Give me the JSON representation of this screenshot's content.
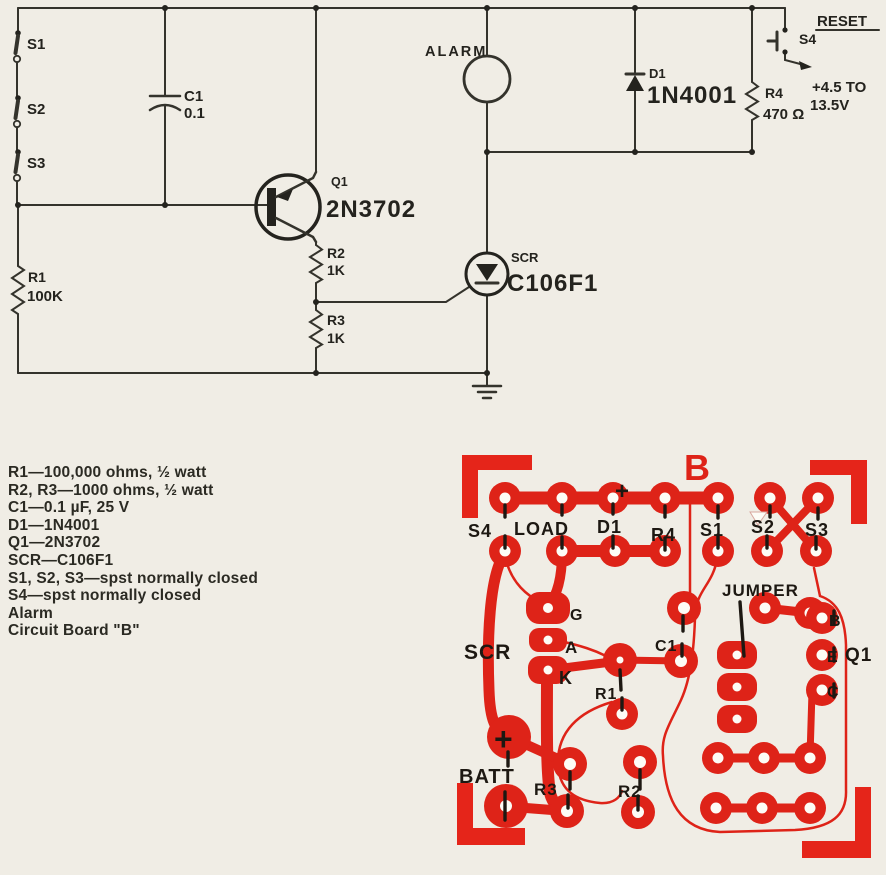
{
  "colors": {
    "paper": "#f0ede5",
    "ink": "#34332c",
    "text": "#24231e",
    "copper": "#de2318",
    "silk": "#1d1812",
    "hole": "#fdfcf6"
  },
  "schematic": {
    "labels": {
      "s1": "S1",
      "s2": "S2",
      "s3": "S3",
      "c1_ref": "C1",
      "c1_val": "0.1",
      "r1_ref": "R1",
      "r1_val": "100K",
      "q1_ref": "Q1",
      "q1_val": "2N3702",
      "r2_ref": "R2",
      "r2_val": "1K",
      "r3_ref": "R3",
      "r3_val": "1K",
      "alarm": "ALARM",
      "scr_ref": "SCR",
      "scr_val": "C106F1",
      "d1_ref": "D1",
      "d1_val": "1N4001",
      "r4_ref": "R4",
      "r4_val": "470 Ω",
      "s4": "S4",
      "reset": "RESET",
      "supply_line1": "+4.5 TO",
      "supply_line2": "13.5V"
    }
  },
  "parts_list": {
    "lines": [
      "R1—100,000 ohms, ½ watt",
      "R2, R3—1000 ohms, ½ watt",
      "C1—0.1 µF, 25 V",
      "D1—1N4001",
      "Q1—2N3702",
      "SCR—C106F1",
      "S1, S2, S3—spst normally closed",
      "S4—spst normally closed",
      "Alarm",
      "Circuit Board \"B\""
    ]
  },
  "pcb": {
    "title": "B",
    "labels": [
      {
        "text": "S4",
        "x": 468,
        "y": 537,
        "size": 18
      },
      {
        "text": "LOAD",
        "x": 514,
        "y": 535,
        "size": 18
      },
      {
        "text": "D1",
        "x": 597,
        "y": 533,
        "size": 18
      },
      {
        "text": "R4",
        "x": 651,
        "y": 541,
        "size": 18
      },
      {
        "text": "S1",
        "x": 700,
        "y": 536,
        "size": 18
      },
      {
        "text": "S2",
        "x": 751,
        "y": 533,
        "size": 18
      },
      {
        "text": "S3",
        "x": 805,
        "y": 536,
        "size": 18
      },
      {
        "text": "+",
        "x": 615,
        "y": 499,
        "size": 24
      },
      {
        "text": "JUMPER",
        "x": 722,
        "y": 596,
        "size": 17
      },
      {
        "text": "C1",
        "x": 655,
        "y": 651,
        "size": 16
      },
      {
        "text": "SCR",
        "x": 464,
        "y": 659,
        "size": 21
      },
      {
        "text": "G",
        "x": 570,
        "y": 620,
        "size": 16
      },
      {
        "text": "A",
        "x": 565,
        "y": 653,
        "size": 17
      },
      {
        "text": "K",
        "x": 559,
        "y": 684,
        "size": 18
      },
      {
        "text": "R1",
        "x": 595,
        "y": 699,
        "size": 16
      },
      {
        "text": "B",
        "x": 829,
        "y": 626,
        "size": 16
      },
      {
        "text": "E",
        "x": 827,
        "y": 662,
        "size": 16
      },
      {
        "text": "Q1",
        "x": 845,
        "y": 661,
        "size": 19
      },
      {
        "text": "C",
        "x": 827,
        "y": 697,
        "size": 16
      },
      {
        "text": "+",
        "x": 494,
        "y": 750,
        "size": 32
      },
      {
        "text": "BATT",
        "x": 459,
        "y": 783,
        "size": 20
      },
      {
        "text": "R3",
        "x": 534,
        "y": 795,
        "size": 17
      },
      {
        "text": "R2",
        "x": 618,
        "y": 797,
        "size": 17
      }
    ]
  }
}
